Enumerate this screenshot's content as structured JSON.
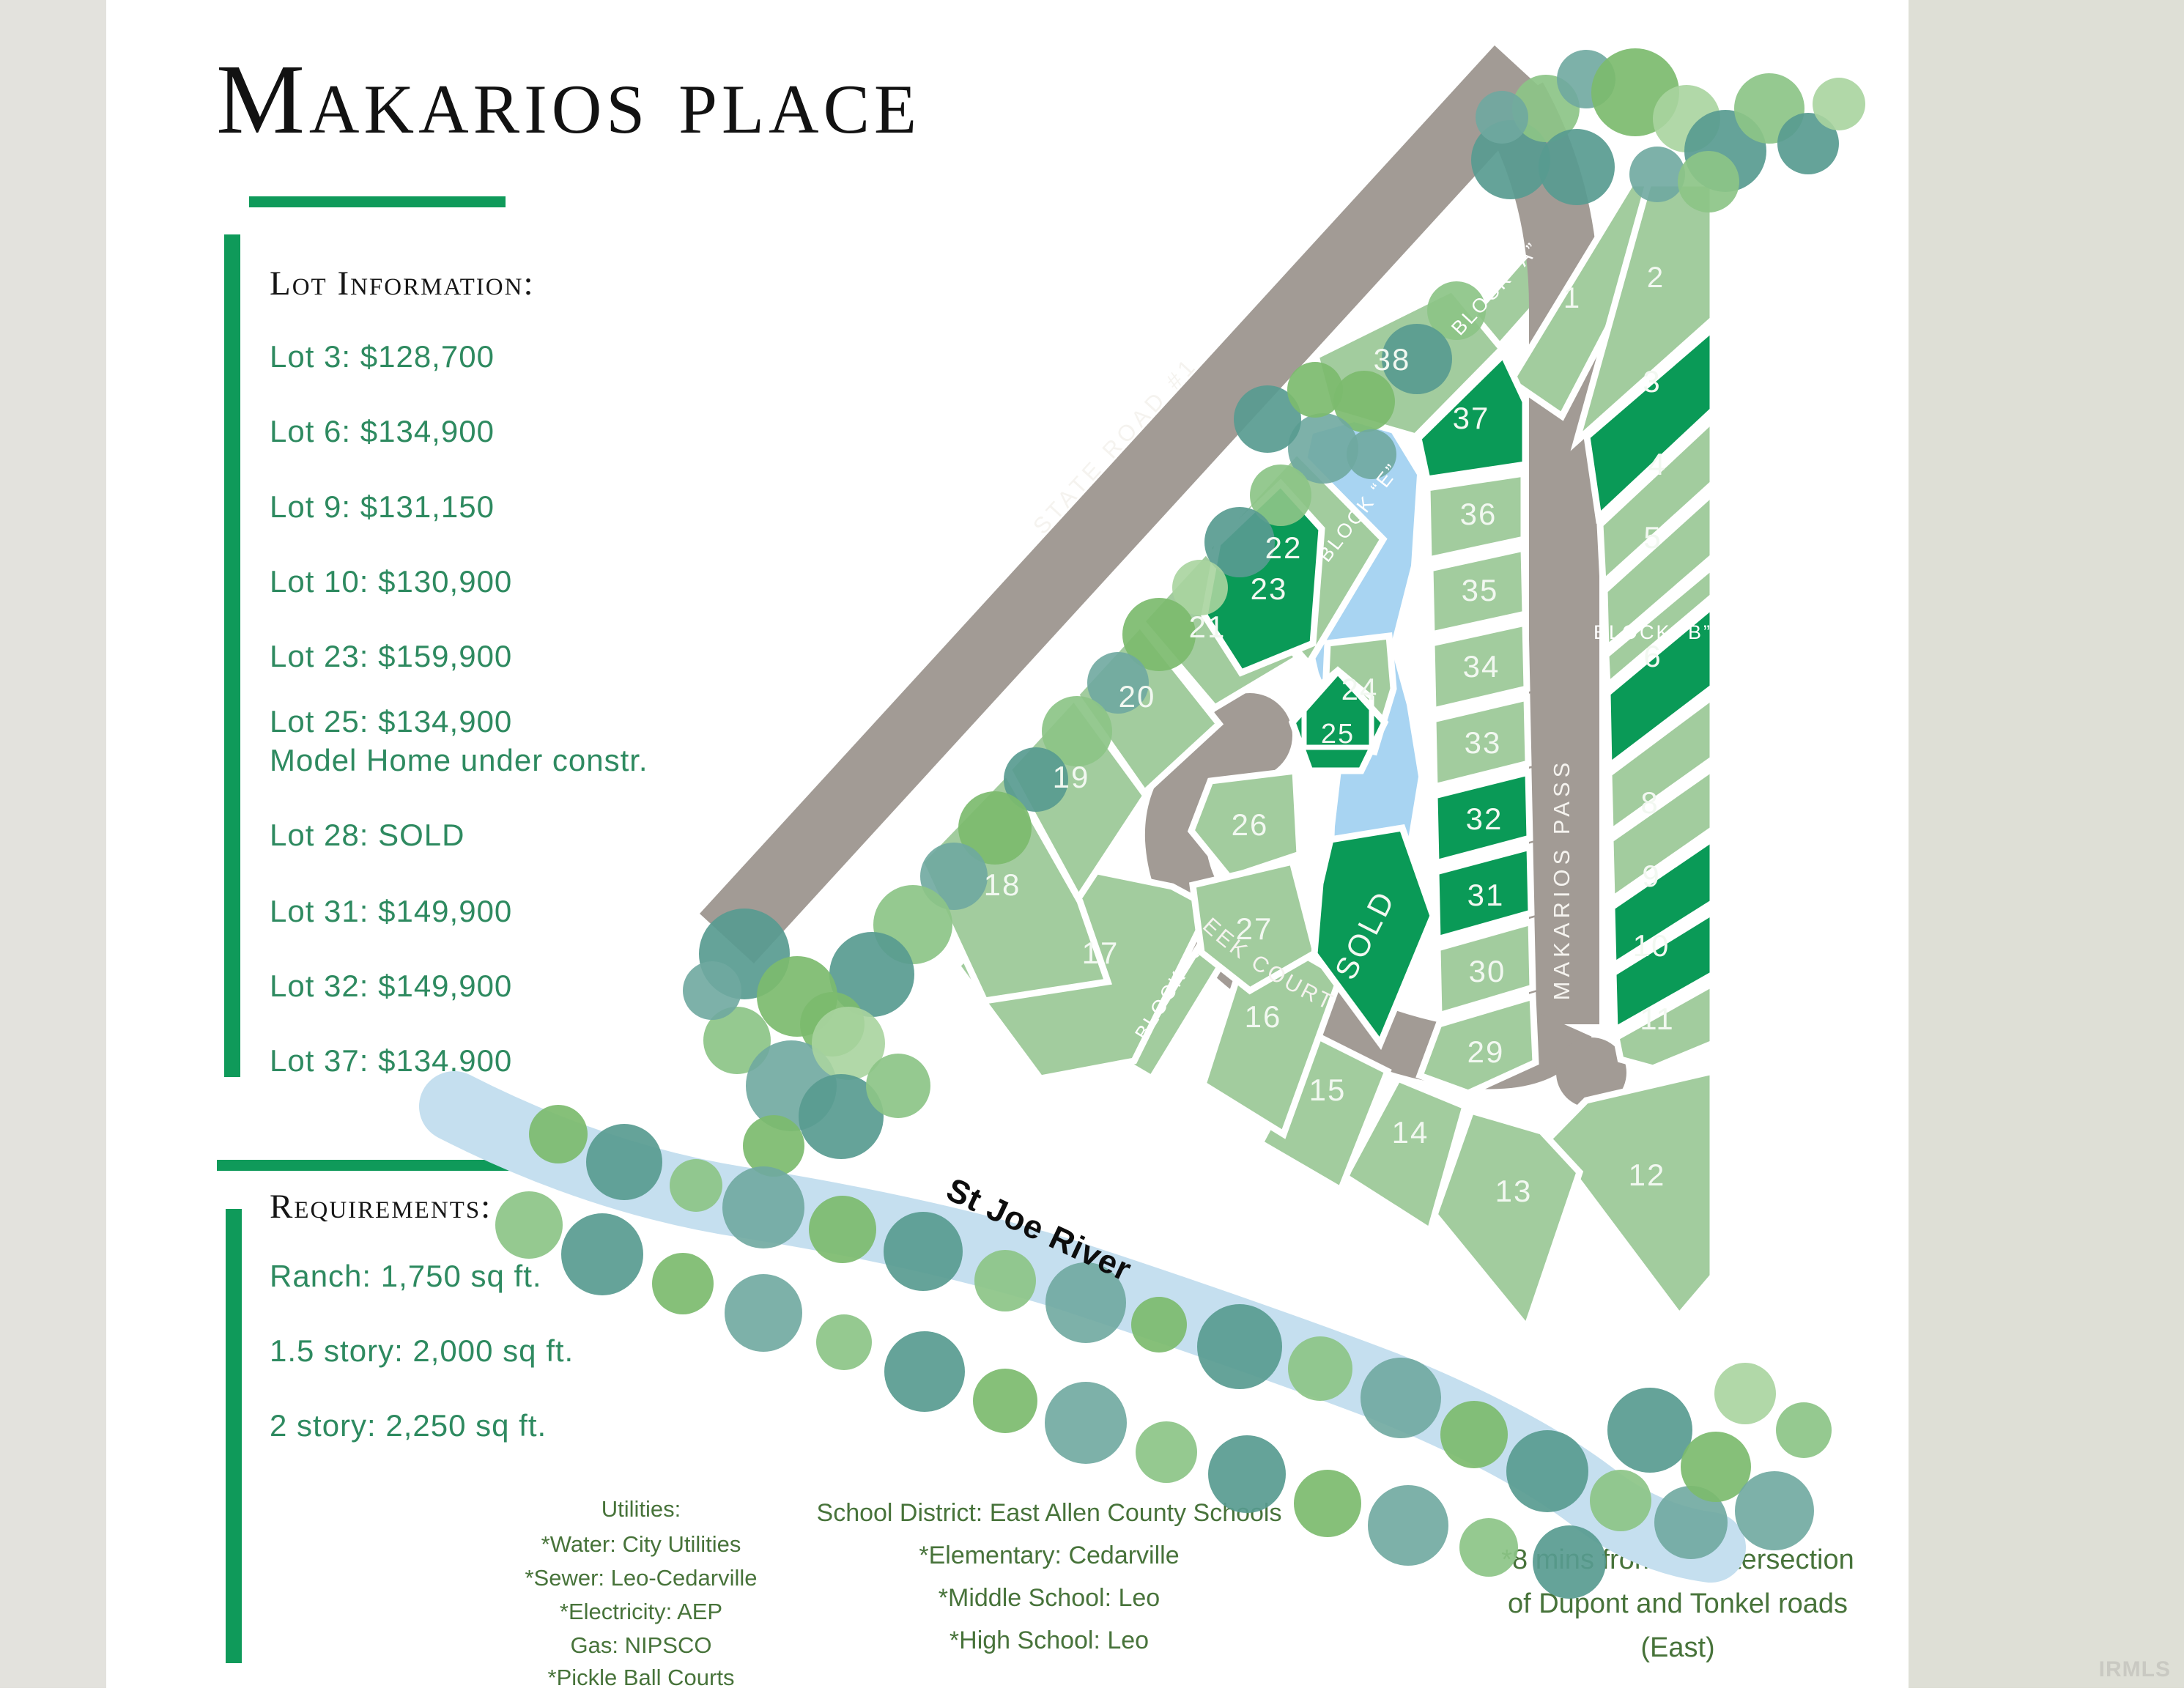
{
  "title": "Makarios place",
  "lot_information": {
    "heading": "Lot Information:",
    "items": [
      "Lot 3: $128,700",
      "Lot 6: $134,900",
      "Lot 9: $131,150",
      "Lot 10: $130,900",
      "Lot 23: $159,900",
      "Lot 25: $134,900",
      "Model Home under constr.",
      "Lot 28: SOLD",
      "Lot 31: $149,900",
      "Lot 32: $149,900",
      "Lot 37: $134,900"
    ]
  },
  "requirements": {
    "heading": "Requirements:",
    "items": [
      "Ranch: 1,750 sq ft.",
      "1.5 story: 2,000 sq ft.",
      "2 story: 2,250 sq ft."
    ]
  },
  "utilities": {
    "heading": "Utilities:",
    "items": [
      "*Water: City Utilities",
      "*Sewer: Leo-Cedarville",
      "*Electricity: AEP",
      "Gas: NIPSCO",
      "*Pickle Ball Courts"
    ]
  },
  "schools": {
    "items": [
      "School District: East Allen County Schools",
      "*Elementary: Cedarville",
      "*Middle School: Leo",
      "*High School: Leo"
    ]
  },
  "location_note": {
    "lines": [
      "*8 mins from the intersection",
      "of Dupont and Tonkel roads",
      "(East)"
    ]
  },
  "watermark": "IRMLS",
  "map": {
    "river": "St Joe River",
    "roads": {
      "state_road": "State Road #1",
      "makarios_pass": "Makarios Pass",
      "conrad_creek": "Conrad Creek Court"
    },
    "blocks": {
      "a": "Block “A”",
      "b": "Block “B”",
      "c": "Block “C”",
      "e": "Block “E”"
    },
    "lots": [
      {
        "number": "1",
        "label": "1",
        "highlighted": false
      },
      {
        "number": "2",
        "label": "2",
        "highlighted": false
      },
      {
        "number": "3",
        "label": "3",
        "highlighted": true
      },
      {
        "number": "4",
        "label": "4",
        "highlighted": false
      },
      {
        "number": "5",
        "label": "5",
        "highlighted": false
      },
      {
        "number": "6",
        "label": "6",
        "highlighted": true
      },
      {
        "number": "7",
        "label": "",
        "highlighted": false
      },
      {
        "number": "8",
        "label": "8",
        "highlighted": false
      },
      {
        "number": "9",
        "label": "9",
        "highlighted": true
      },
      {
        "number": "10",
        "label": "10",
        "highlighted": true
      },
      {
        "number": "11",
        "label": "11",
        "highlighted": false
      },
      {
        "number": "12",
        "label": "12",
        "highlighted": false
      },
      {
        "number": "13",
        "label": "13",
        "highlighted": false
      },
      {
        "number": "14",
        "label": "14",
        "highlighted": false
      },
      {
        "number": "15",
        "label": "15",
        "highlighted": false
      },
      {
        "number": "16",
        "label": "16",
        "highlighted": false
      },
      {
        "number": "17",
        "label": "17",
        "highlighted": false
      },
      {
        "number": "18",
        "label": "18",
        "highlighted": false
      },
      {
        "number": "19",
        "label": "19",
        "highlighted": false
      },
      {
        "number": "20",
        "label": "20",
        "highlighted": false
      },
      {
        "number": "21",
        "label": "21",
        "highlighted": false
      },
      {
        "number": "22",
        "label": "22",
        "highlighted": false
      },
      {
        "number": "23",
        "label": "23",
        "highlighted": true
      },
      {
        "number": "24",
        "label": "24",
        "highlighted": false
      },
      {
        "number": "25",
        "label": "25",
        "highlighted": true
      },
      {
        "number": "26",
        "label": "26",
        "highlighted": false
      },
      {
        "number": "27",
        "label": "27",
        "highlighted": false
      },
      {
        "number": "28",
        "label": "SOLD",
        "highlighted": true,
        "sold": true
      },
      {
        "number": "29",
        "label": "29",
        "highlighted": false
      },
      {
        "number": "30",
        "label": "30",
        "highlighted": false
      },
      {
        "number": "31",
        "label": "31",
        "highlighted": true
      },
      {
        "number": "32",
        "label": "32",
        "highlighted": true
      },
      {
        "number": "33",
        "label": "33",
        "highlighted": false
      },
      {
        "number": "34",
        "label": "34",
        "highlighted": false
      },
      {
        "number": "35",
        "label": "35",
        "highlighted": false
      },
      {
        "number": "36",
        "label": "36",
        "highlighted": false
      },
      {
        "number": "37",
        "label": "37",
        "highlighted": true
      },
      {
        "number": "38",
        "label": "38",
        "highlighted": false
      }
    ]
  },
  "colors": {
    "accent_green": "#0f9a5a",
    "list_green": "#2e8a60",
    "olive_green": "#47733a",
    "lot_light": "#a2cc9e",
    "lot_dark": "#0a9a57",
    "road_gray": "#a29b95",
    "pond_blue": "#a8d4f2",
    "river_blue": "#c5dfef"
  }
}
